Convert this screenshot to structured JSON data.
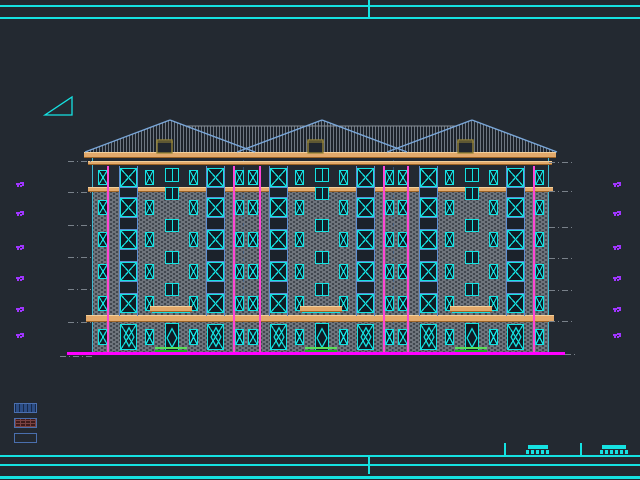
{
  "app": {
    "name": "cad-elevation-drawing",
    "description": "building south elevation, model space"
  },
  "colors": {
    "background": "#232931",
    "cyan": "#15e2e2",
    "tan_band": "#e2a96b",
    "roof_edge_blue": "#7aa7d9",
    "roof_hatch": "#6d7681",
    "wall_gray": "#6f757d",
    "downspout_pink": "#ff45d4",
    "ground_magenta": "#ff00ff",
    "grass_green": "#2ecc2e",
    "marker_purple": "#a035ff",
    "leader_gray": "#79818a",
    "chimney_khaki": "#9a8838"
  },
  "frame": {
    "lines": [
      {
        "x": 0,
        "y": 5,
        "w": 640,
        "h": 2
      },
      {
        "x": 0,
        "y": 17,
        "w": 640,
        "h": 2
      },
      {
        "x": 0,
        "y": 455,
        "w": 640,
        "h": 2
      },
      {
        "x": 0,
        "y": 464,
        "w": 640,
        "h": 2
      },
      {
        "x": 0,
        "y": 476,
        "w": 640,
        "h": 3
      }
    ],
    "ticks": [
      {
        "x": 368,
        "y": 0,
        "h": 19
      },
      {
        "x": 368,
        "y": 457,
        "h": 17
      },
      {
        "x": 504,
        "y": 443,
        "h": 13
      },
      {
        "x": 580,
        "y": 443,
        "h": 13
      }
    ]
  },
  "slope_symbol": {
    "points": "45,115 72,115 72,97"
  },
  "elevation_markers": {
    "left_x": 16,
    "right_x": 613,
    "ys": [
      183,
      212,
      246,
      277,
      308,
      334
    ]
  },
  "leaders": {
    "left": {
      "x": 68,
      "w": 25,
      "ys": [
        161,
        192,
        225,
        257,
        289,
        322
      ]
    },
    "right": {
      "x": 549,
      "w": 26,
      "ys": [
        162,
        191,
        227,
        258,
        290,
        321
      ]
    },
    "ground_left": {
      "x": 60,
      "y": 356,
      "w": 35
    },
    "ground_right": {
      "x": 565,
      "y": 354,
      "w": 11
    }
  },
  "legend": {
    "x": 14,
    "w": 23,
    "h": 10,
    "items": [
      {
        "name": "roof-tile-hatch",
        "style": "legend-tile",
        "y": 403
      },
      {
        "name": "brick-hatch",
        "style": "legend-brick",
        "y": 418
      },
      {
        "name": "plain-finish",
        "style": "legend-plain",
        "y": 433
      }
    ]
  },
  "titleblock": {
    "bars": [
      {
        "x": 528,
        "y": 445,
        "w": 20,
        "h": 4
      },
      {
        "x": 602,
        "y": 445,
        "w": 24,
        "h": 4
      }
    ],
    "texts": [
      {
        "x": 526,
        "y": 450,
        "w": 24
      },
      {
        "x": 600,
        "y": 450,
        "w": 28
      }
    ]
  },
  "building": {
    "wall": {
      "x": 93,
      "right": 548,
      "top": 152,
      "bottom": 352
    },
    "zones": {
      "dark_attic": [
        166,
        192
      ],
      "brick_upper": [
        192,
        322
      ],
      "brick_ground": [
        322,
        352
      ]
    },
    "bands": [
      {
        "x": 84,
        "y": 152,
        "w": 472,
        "h": 6
      },
      {
        "x": 88,
        "y": 161,
        "w": 464,
        "h": 4
      },
      {
        "x": 88,
        "y": 187,
        "w": 465,
        "h": 5
      },
      {
        "x": 86,
        "y": 315,
        "w": 468,
        "h": 7
      }
    ],
    "roof": {
      "hull": "M85,152 L170,120 L186,126 L306,126 L322,120 L338,126 L456,126 L472,120 L557,152 Z",
      "slopes": [
        [
          85,
          152,
          170,
          120
        ],
        [
          170,
          120,
          255,
          152
        ],
        [
          237,
          152,
          322,
          120
        ],
        [
          322,
          120,
          407,
          152
        ],
        [
          387,
          152,
          472,
          120
        ],
        [
          472,
          120,
          557,
          152
        ]
      ],
      "ridge": [
        186,
        126,
        456,
        126
      ],
      "chimneys": [
        {
          "x": 157,
          "y": 140
        },
        {
          "x": 308,
          "y": 140
        },
        {
          "x": 458,
          "y": 140
        }
      ],
      "chimney_w": 15,
      "chimney_h": 13
    },
    "rows": [
      168,
      198,
      230,
      262,
      294
    ],
    "row_h": 19,
    "landing_rows": [
      187,
      219,
      251,
      283
    ],
    "landing_h": 13,
    "units": [
      93,
      243,
      393
    ],
    "unit_w": 150,
    "pattern": [
      {
        "t": "N",
        "off": 5,
        "w": 10
      },
      {
        "t": "B",
        "off": 27,
        "w": 17
      },
      {
        "t": "N",
        "off": 52,
        "w": 9
      },
      {
        "t": "S",
        "off": 72,
        "w": 14
      },
      {
        "t": "N",
        "off": 96,
        "w": 9
      },
      {
        "t": "B",
        "off": 114,
        "w": 17
      },
      {
        "t": "N",
        "off": 142,
        "w": 9
      }
    ],
    "rails_y": [
      166,
      316
    ],
    "downspouts": {
      "xs": [
        107,
        233,
        259,
        383,
        407,
        533
      ],
      "y": 166,
      "bottom": 352
    },
    "axes": [
      243,
      393
    ],
    "canopies": {
      "xs": [
        150,
        300,
        450
      ],
      "w": 42,
      "y": 306,
      "h": 6,
      "cyan_line_y": 312
    },
    "grass": {
      "xs": [
        155,
        305,
        455
      ],
      "w": 32,
      "y": 347,
      "h": 5
    },
    "ground_line": {
      "x": 67,
      "y": 352,
      "w": 498,
      "h": 3
    },
    "ground_windows": {
      "wide_y": 324,
      "wide_h": 26,
      "door_y": 323,
      "door_h": 29,
      "small_y": 329,
      "small_h": 16
    }
  }
}
